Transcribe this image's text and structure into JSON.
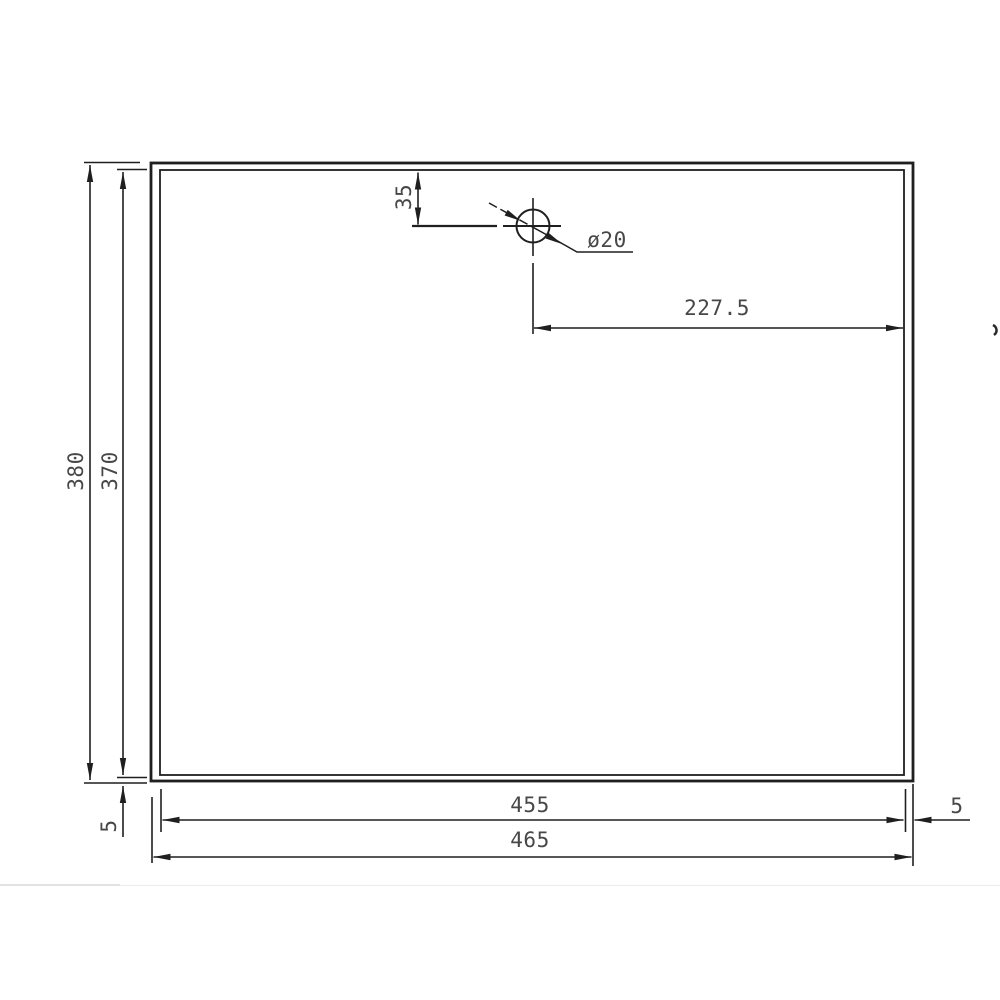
{
  "drawing": {
    "labels": {
      "outer_height": "380",
      "inner_height": "370",
      "bottom_margin": "5",
      "hole_top_offset": "35",
      "hole_center_to_edge": "227.5",
      "inner_width": "455",
      "outer_width": "465",
      "right_margin": "5",
      "hole_diameter": "ø20"
    },
    "colors": {
      "line": "#1f1f1f",
      "text": "#474747",
      "background": "#ffffff"
    }
  }
}
